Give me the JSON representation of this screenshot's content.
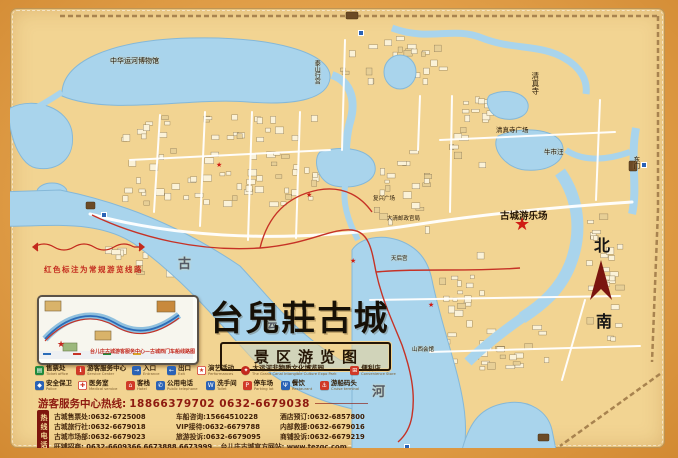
{
  "title": {
    "main": "台兒莊古城",
    "sub": "景区游览图"
  },
  "compass": {
    "north": "北",
    "south": "南"
  },
  "route_note": "红色标注为常规游览线路",
  "inset": {
    "caption": "台儿庄古城游客服务中心—古城西门车船线路图"
  },
  "map_labels": {
    "canal_museum": "中华运河博物馆",
    "taishan_palace": "泰山行宫",
    "mosque": "清真寺",
    "mosque_square": "清真寺广场",
    "niushiwang": "牛市汪",
    "east_gate": "东门",
    "amusement_park": "古城游乐场",
    "fuxing_square": "复兴广场",
    "qing_post": "大清邮政官局",
    "tianhou": "天后宫",
    "shanxi_guild": "山西会馆",
    "gu": "古",
    "yun": "运",
    "he": "河"
  },
  "legend": {
    "row1": [
      {
        "key": "ticket-office",
        "zh": "售票处",
        "en": "Ticket office",
        "color": "#1f8a3d",
        "glyph": "▤",
        "glyphColor": "#ffffff"
      },
      {
        "key": "service-center",
        "zh": "游客服务中心",
        "en": "Service Center",
        "color": "#d03a28",
        "glyph": "ℹ",
        "glyphColor": "#ffffff"
      },
      {
        "key": "entrance",
        "zh": "入口",
        "en": "Entrance",
        "color": "#2a62b5",
        "glyph": "→",
        "glyphColor": "#ffffff"
      },
      {
        "key": "exit",
        "zh": "出口",
        "en": "Exit",
        "color": "#2a62b5",
        "glyph": "←",
        "glyphColor": "#ffffff"
      },
      {
        "key": "performance",
        "zh": "演艺活动",
        "en": "Performances",
        "color": "#ffffff",
        "glyph": "★",
        "glyphColor": "#d03a28"
      },
      {
        "key": "expo-park",
        "zh": "大运河非物质文化博览园",
        "en": "The Grand Canal Intangible Culture Expo Park",
        "color": "#c3271d",
        "glyph": "✦",
        "glyphColor": "#ffffff"
      },
      {
        "key": "convenience-store",
        "zh": "便利店",
        "en": "Convenience Store",
        "color": "#d03a28",
        "glyph": "⊞",
        "glyphColor": "#ffffff"
      }
    ],
    "row2": [
      {
        "key": "security",
        "zh": "安全保卫",
        "en": "Police",
        "color": "#2a62b5",
        "glyph": "◆",
        "glyphColor": "#ffffff"
      },
      {
        "key": "medical",
        "zh": "医务室",
        "en": "Medical service",
        "color": "#ffffff",
        "glyph": "✚",
        "glyphColor": "#d03a28"
      },
      {
        "key": "hotel",
        "zh": "客栈",
        "en": "Hotel",
        "color": "#d03a28",
        "glyph": "⌂",
        "glyphColor": "#ffffff"
      },
      {
        "key": "public-phone",
        "zh": "公用电话",
        "en": "Public telephone",
        "color": "#2a62b5",
        "glyph": "✆",
        "glyphColor": "#ffffff"
      },
      {
        "key": "toilet",
        "zh": "洗手间",
        "en": "Toilet",
        "color": "#2a62b5",
        "glyph": "W",
        "glyphColor": "#ffffff"
      },
      {
        "key": "parking",
        "zh": "停车场",
        "en": "Parking lot",
        "color": "#d03a28",
        "glyph": "P",
        "glyphColor": "#ffffff"
      },
      {
        "key": "restaurant",
        "zh": "餐饮",
        "en": "Restaurant",
        "color": "#2a62b5",
        "glyph": "Ψ",
        "glyphColor": "#ffffff"
      },
      {
        "key": "cruise",
        "zh": "游船码头",
        "en": "Cruise terminal",
        "color": "#d03a28",
        "glyph": "⚓",
        "glyphColor": "#ffffff"
      }
    ]
  },
  "hotline": {
    "label": "游客服务中心热线:",
    "numbers": "18866379702 0632-6679038"
  },
  "phone_tab": "热线电话",
  "phones": {
    "rows": [
      [
        {
          "label": "古城售票处:",
          "num": "0632-6725008"
        },
        {
          "label": "车船咨询:",
          "num": "15664510228"
        },
        {
          "label": "酒店预订:",
          "num": "0632-6857800"
        }
      ],
      [
        {
          "label": "古城旅行社:",
          "num": "0632-6679018"
        },
        {
          "label": "VIP接待:",
          "num": "0632-6679788"
        },
        {
          "label": "内部救援:",
          "num": "0632-6679016"
        }
      ],
      [
        {
          "label": "古城市场部:",
          "num": "0632-6679023"
        },
        {
          "label": "旅游投诉:",
          "num": "0632-6679095"
        },
        {
          "label": "商铺投诉:",
          "num": "0632-6679219"
        }
      ]
    ],
    "last_row": {
      "label": "旺铺招商:",
      "num": "0632-6609366 6673888 6673999",
      "site_label": "台儿庄古城官方网站:",
      "site": "www.tezgc.com"
    }
  },
  "colors": {
    "frame": "#e2a04a",
    "land": "#f2d492",
    "water": "#a9d4ec",
    "route": "#c63226",
    "accent_red": "#8e1a10",
    "wall": "#a8834f"
  }
}
